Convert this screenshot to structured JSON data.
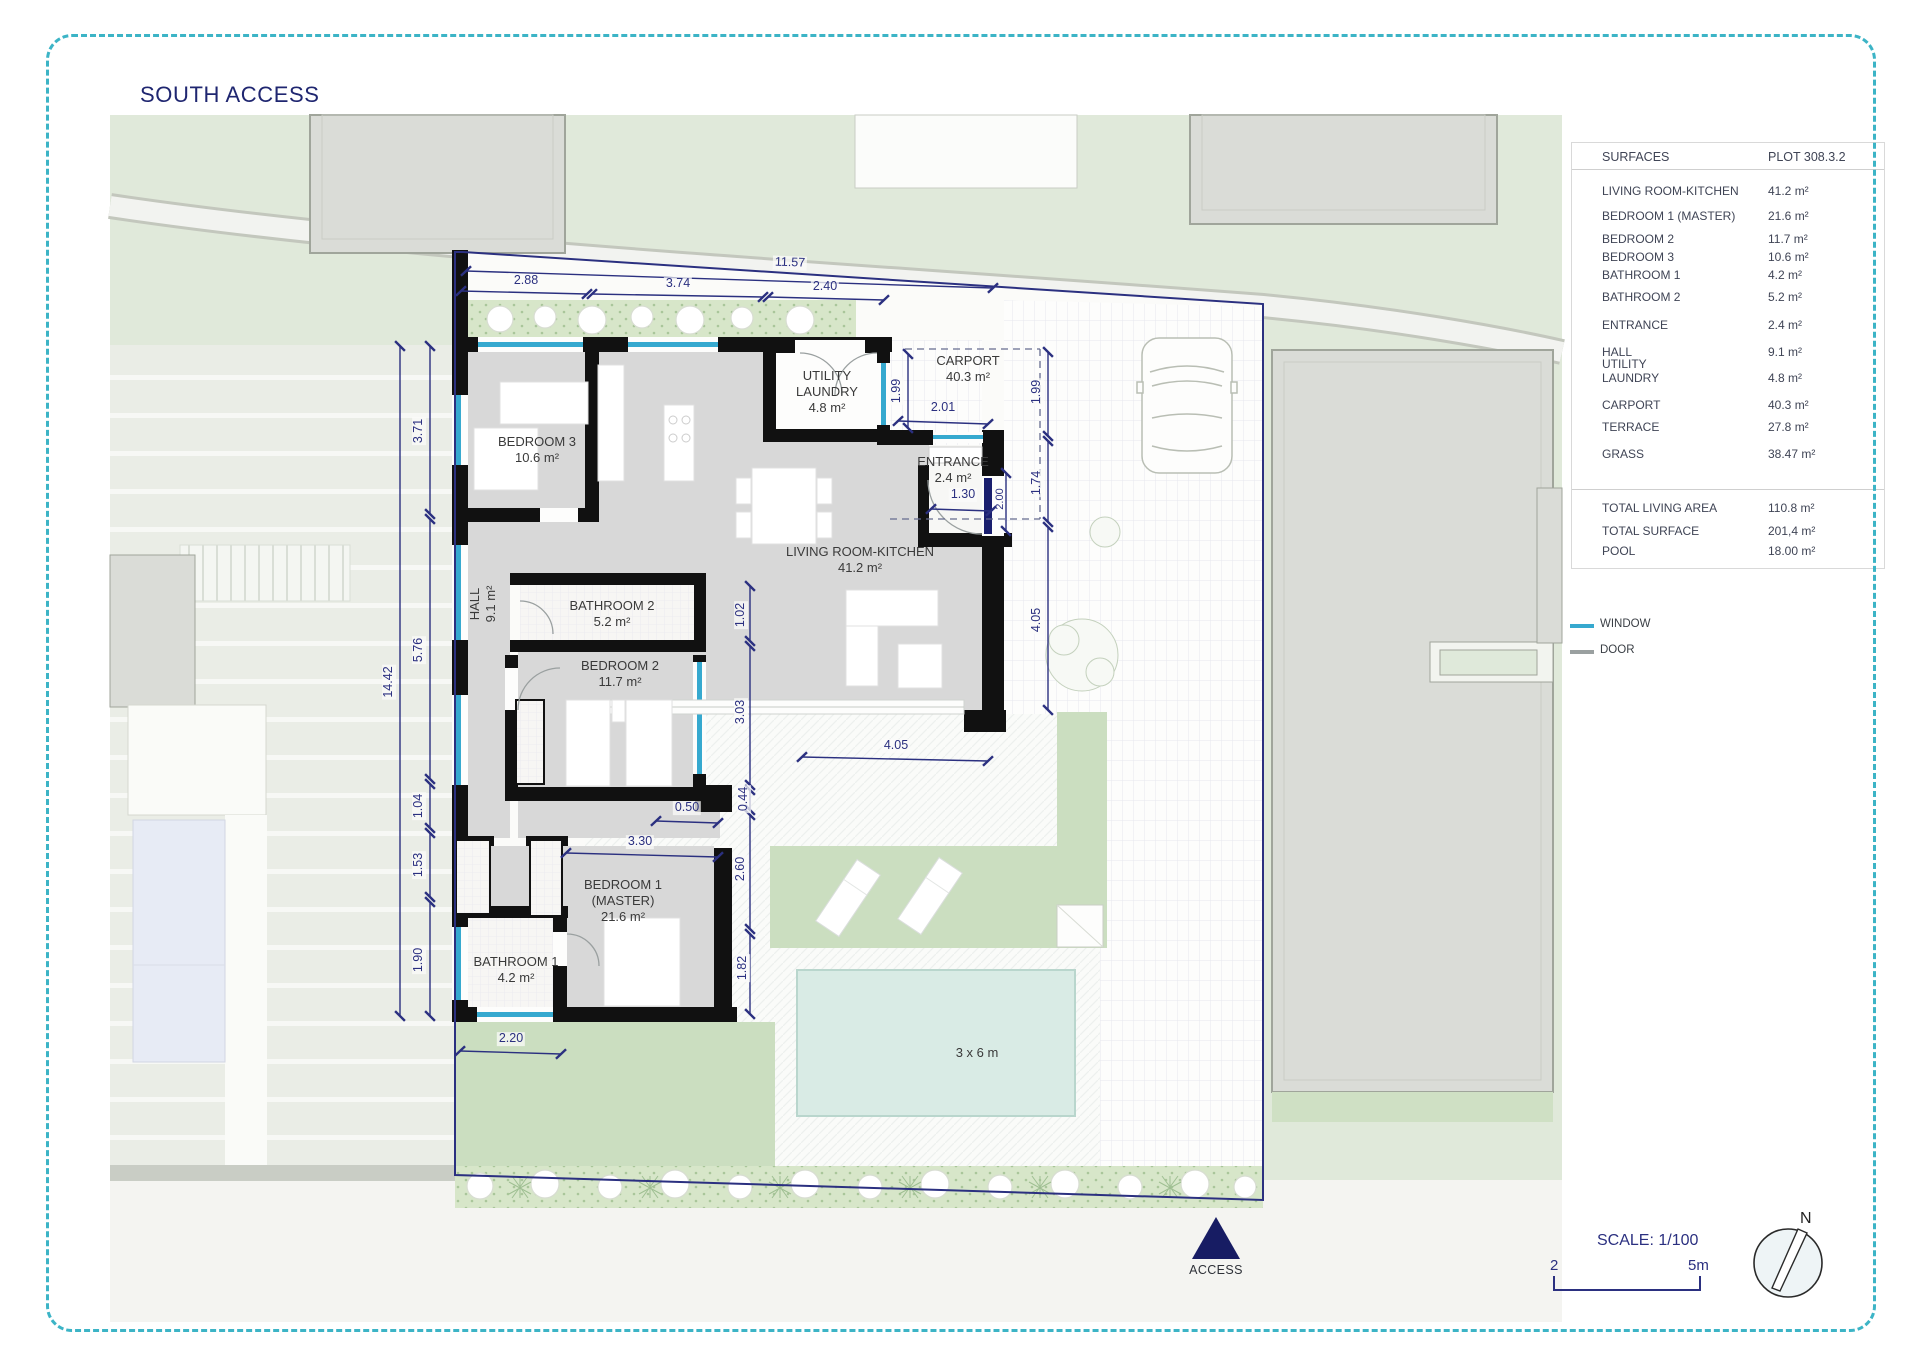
{
  "title": "SOUTH ACCESS",
  "table": {
    "header": {
      "left": "SURFACES",
      "right": "PLOT 308.3.2"
    },
    "rows": [
      {
        "label": "LIVING ROOM-KITCHEN",
        "value": "41.2 m²"
      },
      {
        "label": "BEDROOM 1 (MASTER)",
        "value": "21.6 m²"
      },
      {
        "label": "BEDROOM 2",
        "value": "11.7 m²"
      },
      {
        "label": "BEDROOM 3",
        "value": "10.6 m²"
      },
      {
        "label": "BATHROOM 1",
        "value": "4.2 m²"
      },
      {
        "label": "BATHROOM 2",
        "value": "5.2 m²"
      },
      {
        "label": "ENTRANCE",
        "value": "2.4 m²"
      },
      {
        "label": "HALL",
        "value": "9.1 m²"
      },
      {
        "label": "UTILITY\nLAUNDRY",
        "value": "4.8 m²"
      },
      {
        "label": "CARPORT",
        "value": "40.3 m²"
      },
      {
        "label": "TERRACE",
        "value": "27.8 m²"
      },
      {
        "label": "GRASS",
        "value": "38.47 m²"
      }
    ],
    "totals": [
      {
        "label": "TOTAL LIVING AREA",
        "value": "110.8 m²"
      },
      {
        "label": "TOTAL SURFACE",
        "value": "201,4 m²"
      },
      {
        "label": "POOL",
        "value": "18.00 m²"
      }
    ]
  },
  "legend": {
    "window": "WINDOW",
    "door": "DOOR"
  },
  "scalebar": {
    "text": "SCALE: 1/100",
    "start": "2",
    "end": "5m"
  },
  "compass": {
    "north": "N"
  },
  "access_label": "ACCESS",
  "rooms": {
    "bedroom3": {
      "name": "BEDROOM 3",
      "area": "10.6 m²"
    },
    "utility": {
      "name": "UTILITY\nLAUNDRY",
      "area": "4.8 m²"
    },
    "carport": {
      "name": "CARPORT",
      "area": "40.3 m²"
    },
    "entrance": {
      "name": "ENTRANCE",
      "area": "2.4 m²"
    },
    "living": {
      "name": "LIVING ROOM-KITCHEN",
      "area": "41.2 m²"
    },
    "hall": {
      "name": "HALL",
      "area": "9.1 m²"
    },
    "bathroom2": {
      "name": "BATHROOM 2",
      "area": "5.2 m²"
    },
    "bedroom2": {
      "name": "BEDROOM 2",
      "area": "11.7 m²"
    },
    "bedroom1": {
      "name": "BEDROOM 1\n(MASTER)",
      "area": "21.6 m²"
    },
    "bathroom1": {
      "name": "BATHROOM 1",
      "area": "4.2 m²"
    },
    "pool": {
      "label": "3 x 6 m"
    }
  },
  "dims": {
    "top": [
      "11.57",
      "2.88",
      "3.74",
      "2.40"
    ],
    "left": [
      "14.42",
      "3.71",
      "5.76",
      "1.04",
      "1.53",
      "1.90"
    ],
    "right": [
      "1.99",
      "2.01",
      "1.99",
      "1.74",
      "4.05"
    ],
    "inner": [
      "1.02",
      "3.03",
      "0.44",
      "2.60",
      "1.82"
    ],
    "bottom": [
      "4.05",
      "0.50",
      "3.30",
      "2.20",
      "1.30",
      "2.00"
    ]
  },
  "colors": {
    "accent": "#2b3080",
    "window": "#36a9cf",
    "door": "#9aa0a0",
    "border": "#3cb4c6"
  }
}
